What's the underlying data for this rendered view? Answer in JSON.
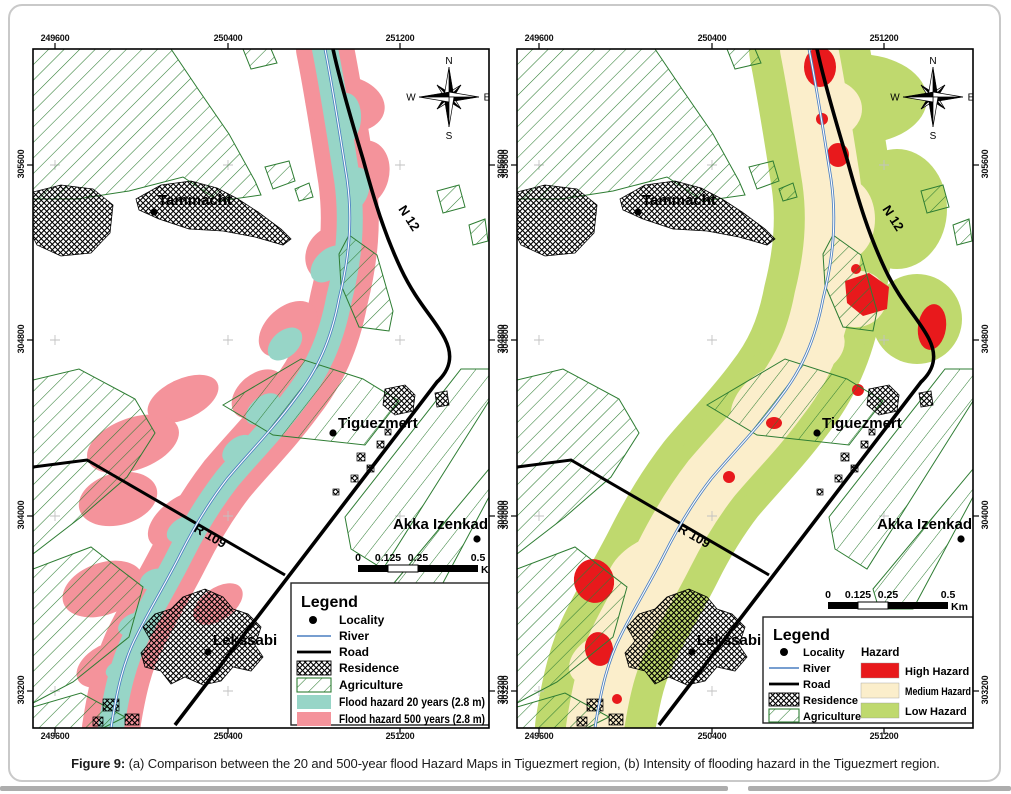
{
  "figure": {
    "caption_label": "Figure 9:",
    "caption_text": " (a) Comparison between the 20 and 500-year flood Hazard Maps in Tiguezmert region, (b) Intensity of flooding hazard in the Tiguezmert region."
  },
  "axes": {
    "x_ticks": [
      "249600",
      "250400",
      "251200"
    ],
    "y_ticks": [
      "305600",
      "304800",
      "304000",
      "303200"
    ]
  },
  "compass": {
    "n": "N",
    "e": "E",
    "s": "S",
    "w": "W"
  },
  "scalebar": {
    "ticks": [
      "0",
      "0.125",
      "0.25",
      "0.5"
    ],
    "unit": "Km"
  },
  "map_labels": {
    "localities": [
      "Tammacht",
      "Tiguezmert",
      "Akka Izenkad",
      "Lekssabi"
    ],
    "roads": [
      "N 12",
      "R 109"
    ]
  },
  "legend_a": {
    "title": "Legend",
    "items": [
      "Locality",
      "River",
      "Road",
      "Residence",
      "Agriculture",
      "Flood hazard 20 years (2.8 m)",
      "Flood hazard 500 years (2.8 m)"
    ]
  },
  "legend_b": {
    "title": "Legend",
    "hazard_header": "Hazard",
    "items": [
      "Locality",
      "River",
      "Road",
      "Residence",
      "Agriculture"
    ],
    "hazard_items": [
      "High Hazard",
      "Medium Hazard",
      "Low Hazard"
    ]
  },
  "colors": {
    "flood_20yr": "#97d5c7",
    "flood_500yr": "#f4939b",
    "high_hazard": "#e8191c",
    "medium_hazard": "#fbeecb",
    "low_hazard": "#bfd96e",
    "agriculture_line": "#2e7d33",
    "river": "#4a7fc1",
    "road": "#000000"
  }
}
